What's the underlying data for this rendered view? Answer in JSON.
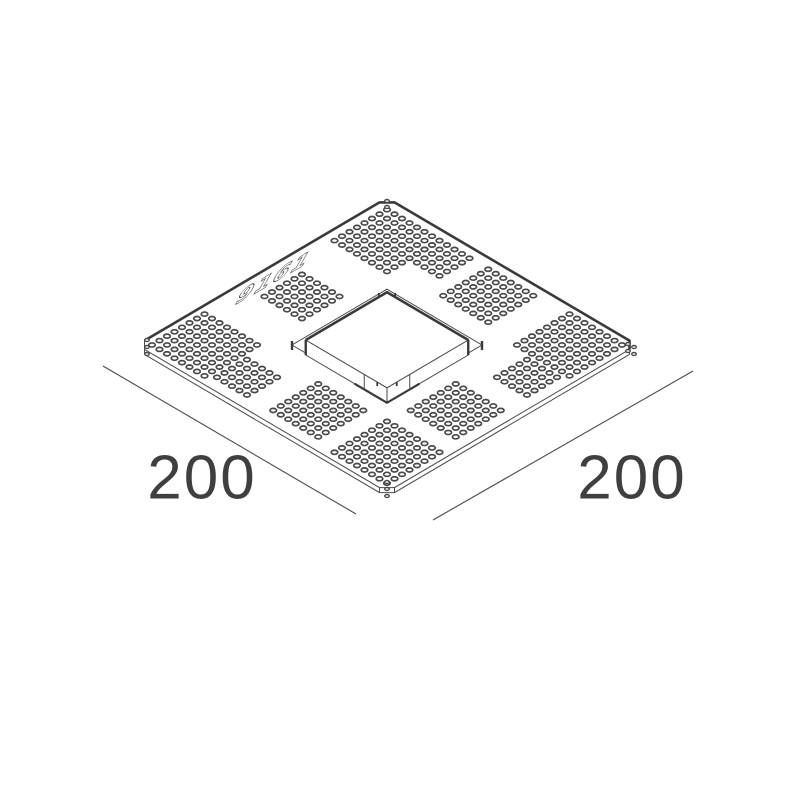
{
  "drawing": {
    "dimension_left": "200",
    "dimension_right": "200",
    "stamp_text": "9161",
    "colors": {
      "line": "#4a4a4a",
      "thick": "#3a3a3a",
      "label": "#3f3f3f",
      "bg": "#ffffff"
    },
    "geometry": {
      "ox": 387,
      "oy": 198,
      "kx": 1.25,
      "ky": 0.735,
      "plate": {
        "size": 200,
        "chamfer": 6,
        "thickness": 5
      },
      "box": {
        "min": 67.5,
        "max": 132.5,
        "lift": 5,
        "drop": 15
      },
      "rim": {
        "min": 62,
        "max": 138
      },
      "hole": {
        "pitch": 6,
        "rx": 3.3,
        "ry": 2.05
      },
      "patches": [
        {
          "u": 29,
          "v": 29,
          "n": 8
        },
        {
          "u": 173,
          "v": 27,
          "n": 8
        },
        {
          "u": 27,
          "v": 173,
          "n": 8
        },
        {
          "u": 173,
          "v": 173,
          "n": 8
        },
        {
          "u": 62,
          "v": 20,
          "n": 5
        },
        {
          "u": 107,
          "v": 26,
          "n": 7
        },
        {
          "u": 33,
          "v": 101,
          "n": 6
        },
        {
          "u": 66,
          "v": 178,
          "n": 5
        },
        {
          "u": 117,
          "v": 172,
          "n": 7
        },
        {
          "u": 178,
          "v": 66,
          "n": 5
        },
        {
          "u": 172,
          "v": 117,
          "n": 7
        }
      ],
      "corner_holes": [
        {
          "x": 387,
          "y": 201,
          "stack": [
            [
              0,
              0
            ],
            [
              0,
              6
            ]
          ]
        },
        {
          "x": 147,
          "y": 340,
          "stack": [
            [
              0,
              0
            ],
            [
              0,
              7
            ],
            [
              0,
              14
            ]
          ]
        },
        {
          "x": 628,
          "y": 344,
          "stack": [
            [
              0,
              0
            ],
            [
              6,
              3
            ],
            [
              0,
              7
            ],
            [
              6,
              10
            ]
          ]
        },
        {
          "x": 387,
          "y": 482,
          "stack": [
            [
              0,
              0
            ],
            [
              0,
              7
            ],
            [
              0,
              14
            ]
          ]
        }
      ],
      "stamp": {
        "x": 233,
        "y": 306,
        "size": 26
      },
      "dim_lines": [
        {
          "x1": 103,
          "y1": 366,
          "x2": 356,
          "y2": 514
        },
        {
          "x1": 433,
          "y1": 520,
          "x2": 693,
          "y2": 371
        }
      ]
    }
  }
}
